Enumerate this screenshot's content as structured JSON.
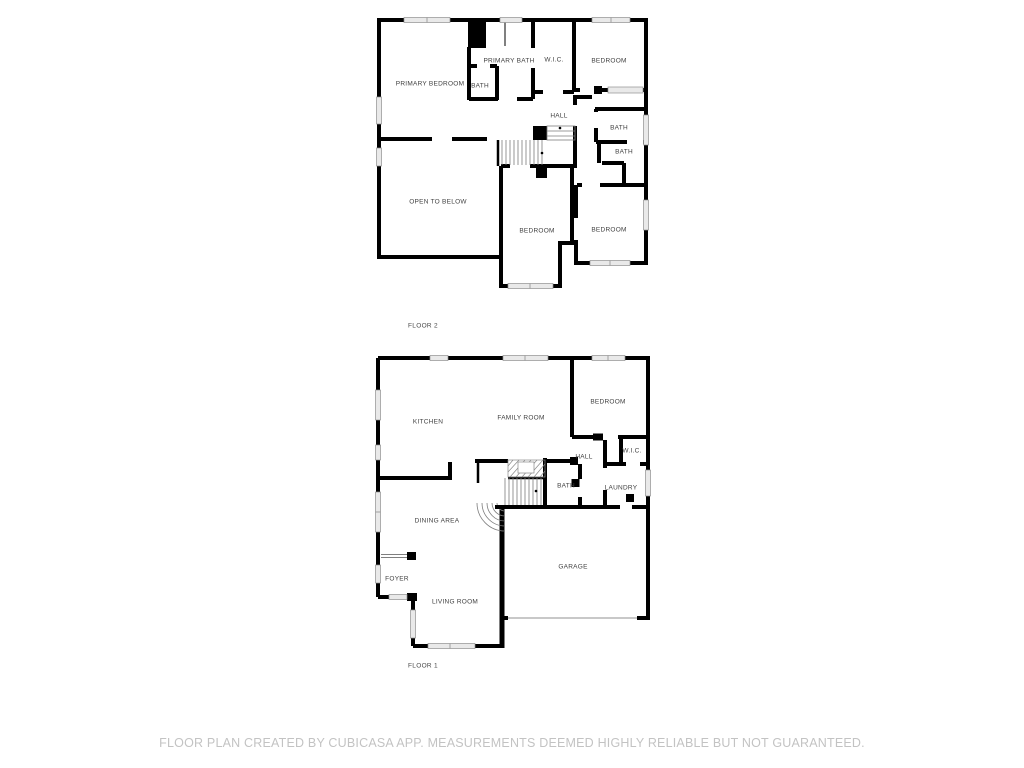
{
  "document": {
    "type": "floor-plan",
    "background": "#ffffff"
  },
  "floor2": {
    "label": "FLOOR 2",
    "rooms": {
      "primary_bedroom": "PRIMARY BEDROOM",
      "primary_bath": "PRIMARY BATH",
      "bath_small": "BATH",
      "wic": "W.I.C.",
      "bedroom_top": "BEDROOM",
      "hall": "HALL",
      "bath_right_upper": "BATH",
      "bath_right_lower": "BATH",
      "open_to_below": "OPEN TO BELOW",
      "bedroom_mid": "BEDROOM",
      "bedroom_right": "BEDROOM"
    }
  },
  "floor1": {
    "label": "FLOOR 1",
    "rooms": {
      "kitchen": "KITCHEN",
      "family_room": "FAMILY ROOM",
      "bedroom": "BEDROOM",
      "hall": "HALL",
      "wic": "W.I.C.",
      "bath": "BATH",
      "laundry": "LAUNDRY",
      "dining_area": "DINING AREA",
      "foyer": "FOYER",
      "living_room": "LIVING ROOM",
      "garage": "GARAGE"
    }
  },
  "footer": {
    "disclaimer": "FLOOR PLAN CREATED BY CUBICASA APP. MEASUREMENTS DEEMED HIGHLY RELIABLE BUT NOT GUARANTEED."
  },
  "colors": {
    "wall": "#000000",
    "window_fill": "#e9e9e9",
    "window_edge": "#8f8f8f",
    "room_label": "#3f3f3f",
    "footer_text": "#c3c3c3"
  }
}
